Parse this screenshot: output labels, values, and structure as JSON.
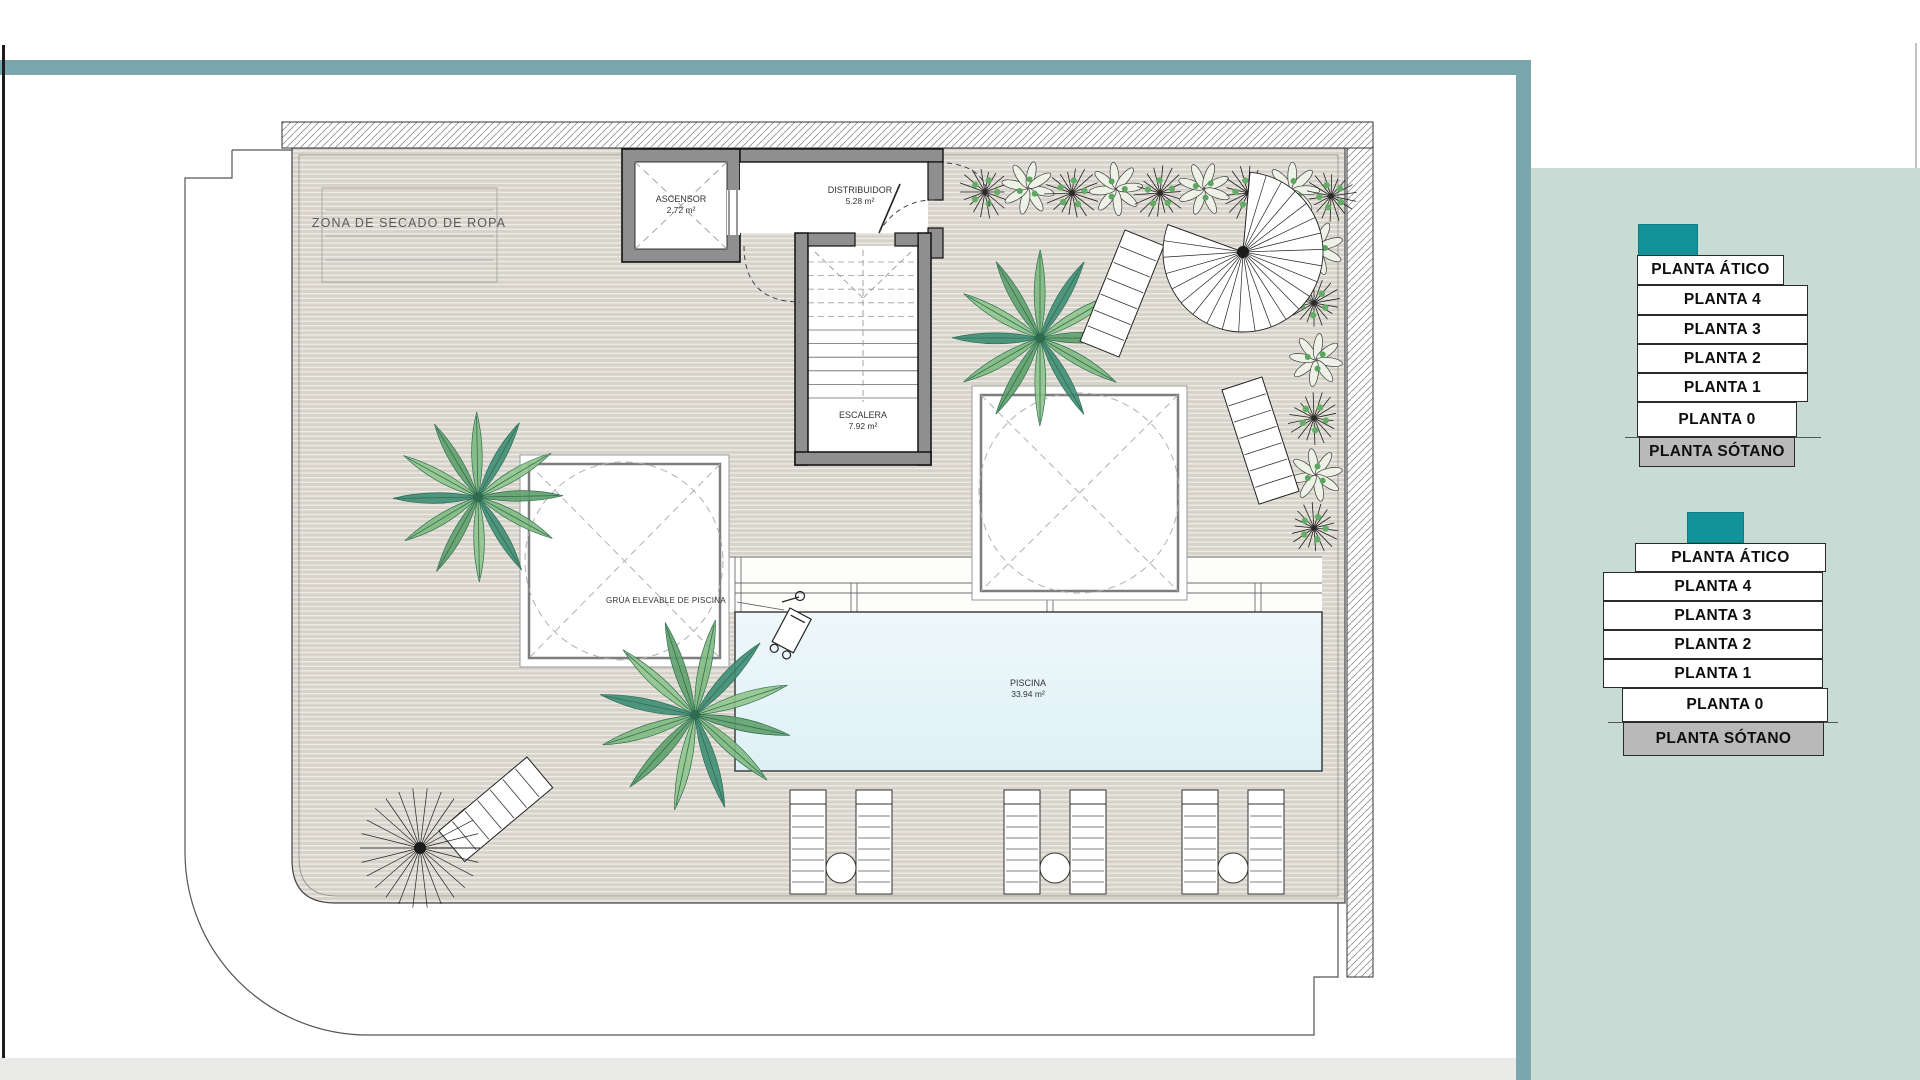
{
  "colors": {
    "accent_teal": "#14929a",
    "frame_teal": "#7ba6ae",
    "sidebar_panel": "#c8dcd5",
    "sotano_gray": "#b9b9b9",
    "pool_blue": "#e7f3f8",
    "deck_beige": "#d7d3ca"
  },
  "plan": {
    "zona_secado_label": "ZONA DE SECADO DE ROPA",
    "ascensor": {
      "name": "ASCENSOR",
      "area": "2.72 m²"
    },
    "distribuidor": {
      "name": "DISTRIBUIDOR",
      "area": "5.28 m²"
    },
    "escalera": {
      "name": "ESCALERA",
      "area": "7.92 m²"
    },
    "piscina": {
      "name": "PISCINA",
      "area": "33.94 m²"
    },
    "grua_label": "GRÚA ELEVABLE DE PISCINA"
  },
  "selectors": [
    {
      "name": "floor-selector-upper",
      "floors": [
        "PLANTA ÁTICO",
        "PLANTA 4",
        "PLANTA 3",
        "PLANTA 2",
        "PLANTA 1",
        "PLANTA 0",
        "PLANTA SÓTANO"
      ]
    },
    {
      "name": "floor-selector-lower",
      "floors": [
        "PLANTA ÁTICO",
        "PLANTA 4",
        "PLANTA 3",
        "PLANTA 2",
        "PLANTA 1",
        "PLANTA 0",
        "PLANTA SÓTANO"
      ]
    }
  ]
}
